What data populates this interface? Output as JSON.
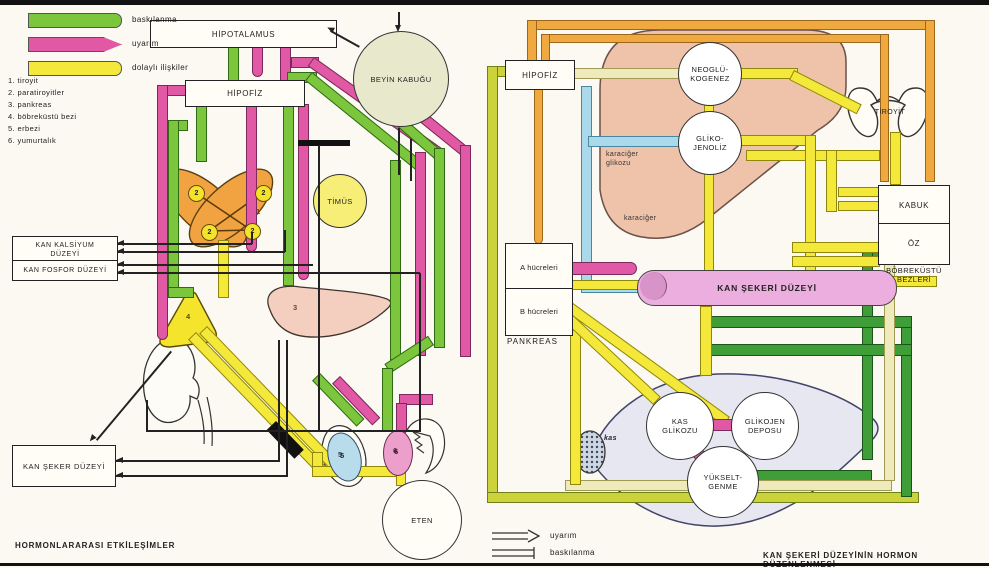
{
  "left": {
    "caption": "HORMONLARARASI ETKİLEŞİMLER",
    "legend": [
      {
        "label": "baskılanma"
      },
      {
        "label": "uyarım"
      },
      {
        "label": "dolaylı ilişkiler"
      }
    ],
    "list": [
      "1. tiroyit",
      "2. paratiroyitler",
      "3. pankreas",
      "4. böbreküstü bezi",
      "5. erbezi",
      "6. yumurtalık"
    ],
    "boxes": {
      "hipotalamus": "HİPOTALAMUS",
      "hipofiz": "HİPOFİZ",
      "kan_kalsiyum_1": "KAN KALSİYUM",
      "kan_kalsiyum_2": "DÜZEYİ",
      "kan_fosfor": "KAN FOSFOR DÜZEYİ",
      "kan_seker": "KAN ŞEKER DÜZEYİ"
    },
    "circles": {
      "beyin_kabugu": "BEYİN KABUĞU",
      "timus": "TİMÜS",
      "eten": "ETEN"
    },
    "organ_numbers": {
      "tiroyit": "1",
      "paratiroyit": "2",
      "pankreas": "3",
      "bobrekustu": "4",
      "erbezi": "5",
      "yumurtalik": "6"
    }
  },
  "right": {
    "caption": "KAN ŞEKERİ DÜZEYİNİN HORMON DÜZENLENMESİ",
    "legend": [
      {
        "label": "uyarım"
      },
      {
        "label": "baskılanma"
      }
    ],
    "boxes": {
      "hipofiz": "HİPOFİZ",
      "a_hucreleri": "A hücreleri",
      "b_hucreleri": "B hücreleri",
      "kabuk": "KABUK",
      "oz": "ÖZ"
    },
    "labels": {
      "pankreas": "PANKREAS",
      "bobrekustu_1": "BÖBREKÜSTÜ",
      "bobrekustu_2": "BEZLERİ",
      "tiroyit": "TİROYİT",
      "karaciger": "karaciğer",
      "karaciger_glikozu_1": "karaciğer",
      "karaciger_glikozu_2": "glikozu",
      "kas": "kas"
    },
    "circles": {
      "neogluko_1": "NEOGLÜ-",
      "neogluko_2": "KOGENEZ",
      "glikojenoliz_1": "GLİKO-",
      "glikojenoliz_2": "JENOLİZ",
      "kas_glikozu_1": "KAS",
      "kas_glikozu_2": "GLİKOZU",
      "glikojen_1": "GLİKOJEN",
      "glikojen_2": "DEPOSU",
      "yukselt_1": "YÜKSELT-",
      "yukselt_2": "GENME"
    },
    "cylinder": "KAN ŞEKERİ DÜZEYİ"
  }
}
